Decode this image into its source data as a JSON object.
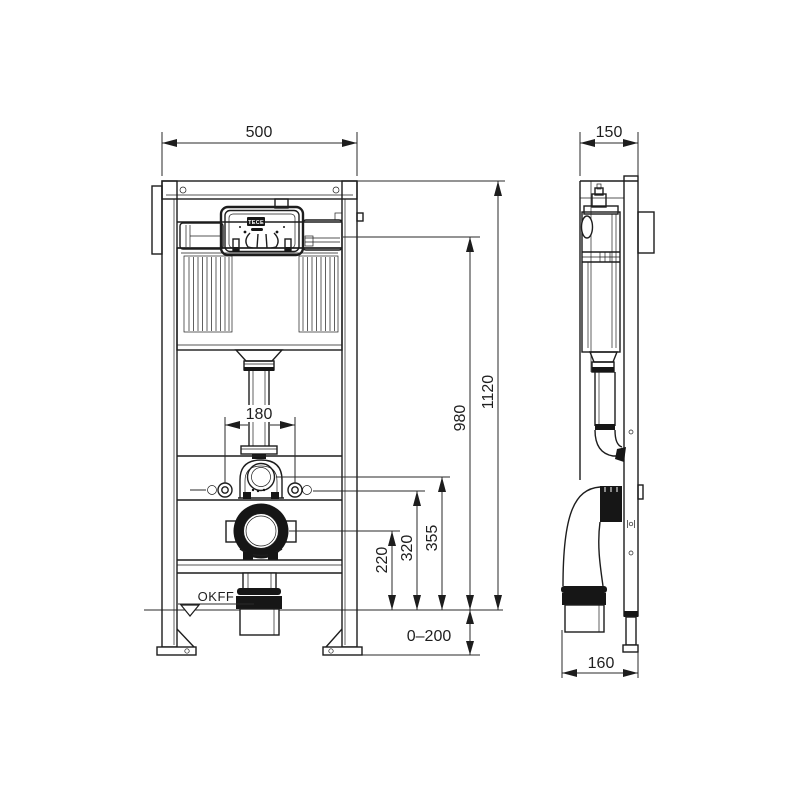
{
  "dimensions": {
    "front_width": "500",
    "side_depth": "150",
    "bolt_spacing": "180",
    "total_height": "1120",
    "panel_height": "980",
    "flush_bend_height": "355",
    "bolt_height": "320",
    "drain_height": "220",
    "foot_adjust_range": "0–200",
    "outlet_offset": "160"
  },
  "labels": {
    "floor_level": "OKFF",
    "brand": "TECE"
  }
}
